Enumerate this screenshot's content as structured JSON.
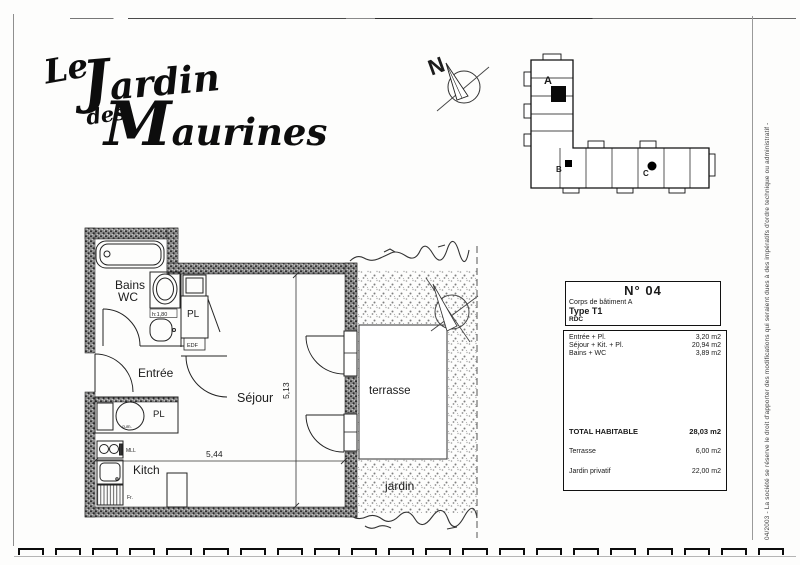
{
  "logo": {
    "word1": "Le",
    "word2": "Jardin",
    "word3": "des",
    "word4": "Maurines"
  },
  "compass": {
    "north": "N"
  },
  "site_plan": {
    "label_a": "A",
    "label_b": "B",
    "label_c": "C"
  },
  "floor_plan": {
    "rooms": {
      "bains": "Bains",
      "wc": "WC",
      "entree": "Entrée",
      "sejour": "Séjour",
      "kitch": "Kitch",
      "terrasse": "terrasse",
      "jardin": "jardin"
    },
    "fixtures": {
      "pl_bath": "PL",
      "pl_entry": "PL",
      "edf": "EDF",
      "cum": "cum.",
      "mll": "MLL",
      "fr": "Fr.",
      "height_note": "h:1,80"
    },
    "dimensions": {
      "width": "5,44",
      "depth": "5,13"
    }
  },
  "info_box": {
    "number": "N° 04",
    "building": "Corps de bâtiment  A",
    "unit_type": "Type T1",
    "floor": "RDC",
    "areas": [
      {
        "label": "Entrée + Pl.",
        "value": "3,20 m2"
      },
      {
        "label": "Séjour + Kit. + Pl.",
        "value": "20,94 m2"
      },
      {
        "label": "Bains + WC",
        "value": "3,89 m2"
      }
    ],
    "total": {
      "label": "TOTAL HABITABLE",
      "value": "28,03 m2"
    },
    "terrasse_row": {
      "label": "Terrasse",
      "value": "6,00 m2"
    },
    "jardin_row": {
      "label": "Jardin privatif",
      "value": "22,00 m2"
    }
  },
  "side_note": "04/2003 - La société se réserve le droit d'apporter des modifications qui seraient dues à des impératifs d'ordre technique ou administratif -"
}
